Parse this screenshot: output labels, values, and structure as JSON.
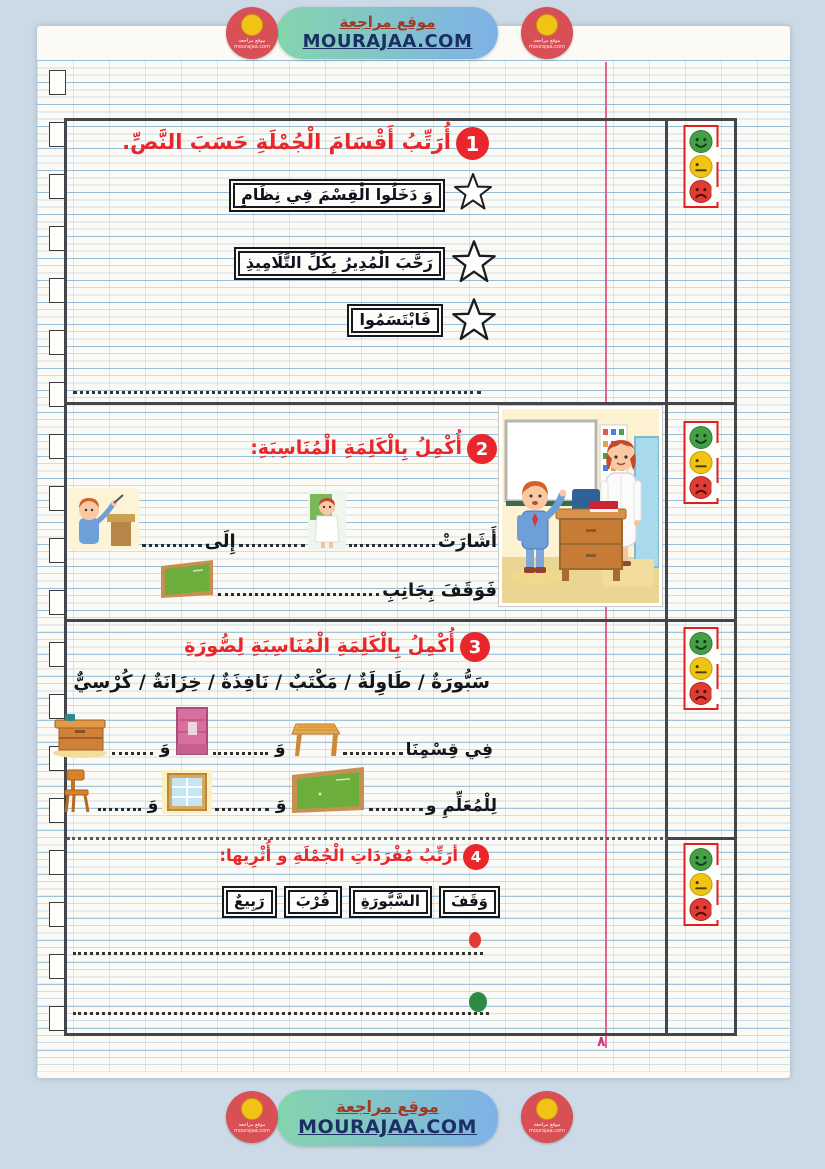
{
  "banner": {
    "site_name": "موقع مراجعة",
    "site_url": "MOURAJAA.COM",
    "logo_caption": "موقع مراجعة",
    "logo_url": "mourajaa.com"
  },
  "margin": {
    "page_number": "٨"
  },
  "rating": {
    "good_color": "#43a047",
    "average_color": "#f0c413",
    "weak_color": "#e23b33",
    "frame_color": "#e02020"
  },
  "colors": {
    "title_red": "#e8262b",
    "margin_pink": "#e24a7f",
    "banner_green": "#84d5ad",
    "banner_blue": "#7fb1e8"
  },
  "icons": {
    "star": "☆",
    "smiley_good": "happy-face",
    "smiley_average": "neutral-face",
    "smiley_weak": "sad-face"
  },
  "exercise1": {
    "number": "1",
    "title": "أُرَتِّبُ أَقْسَامَ الْجُمْلَةِ حَسَبَ النَّصِّ.",
    "phrases": [
      "وَ دَخَلُوا الْقِسْمَ فِي نِظَامٍ",
      "رَحَّبَ الْمُدِيرُ بِكُلِّ التَّلَامِيذِ",
      "فَابْتَسَمُوا"
    ]
  },
  "exercise2": {
    "number": "2",
    "title": "أُكْمِلُ بِالْكَلِمَةِ الْمُنَاسِبَةِ:",
    "line1_word1": "أَشَارَتْ",
    "line1_word2": "إِلَى",
    "line2_lead": "فَوَقَفَ بِجَانِبِ"
  },
  "exercise3": {
    "number": "3",
    "title": "أُكْمِلُ بِالْكَلِمَةِ الْمُنَاسِبَةِ لِصُّورَةِ",
    "word_bank": "سَبُّورَةٌ / طَاوِلَةٌ / مَكْتَبٌ /  نَافِذَةٌ /  خِزَانَةٌ / كُرْسِيٌّ",
    "row1_lead": "فِي قِسْمِنَا",
    "row2_lead": "لِلْمُعَلِّمِ و",
    "conjunction": "وَ"
  },
  "exercise4": {
    "number": "4",
    "title": "أرَتِّبُ مُفْرَدَاتِ الْجُمْلَةِ و أُثْرِيها:",
    "words": [
      "وَقَفَ",
      "السَّبُّورَةِ",
      "قُرْبَ",
      "رَبِيعٌ"
    ]
  }
}
